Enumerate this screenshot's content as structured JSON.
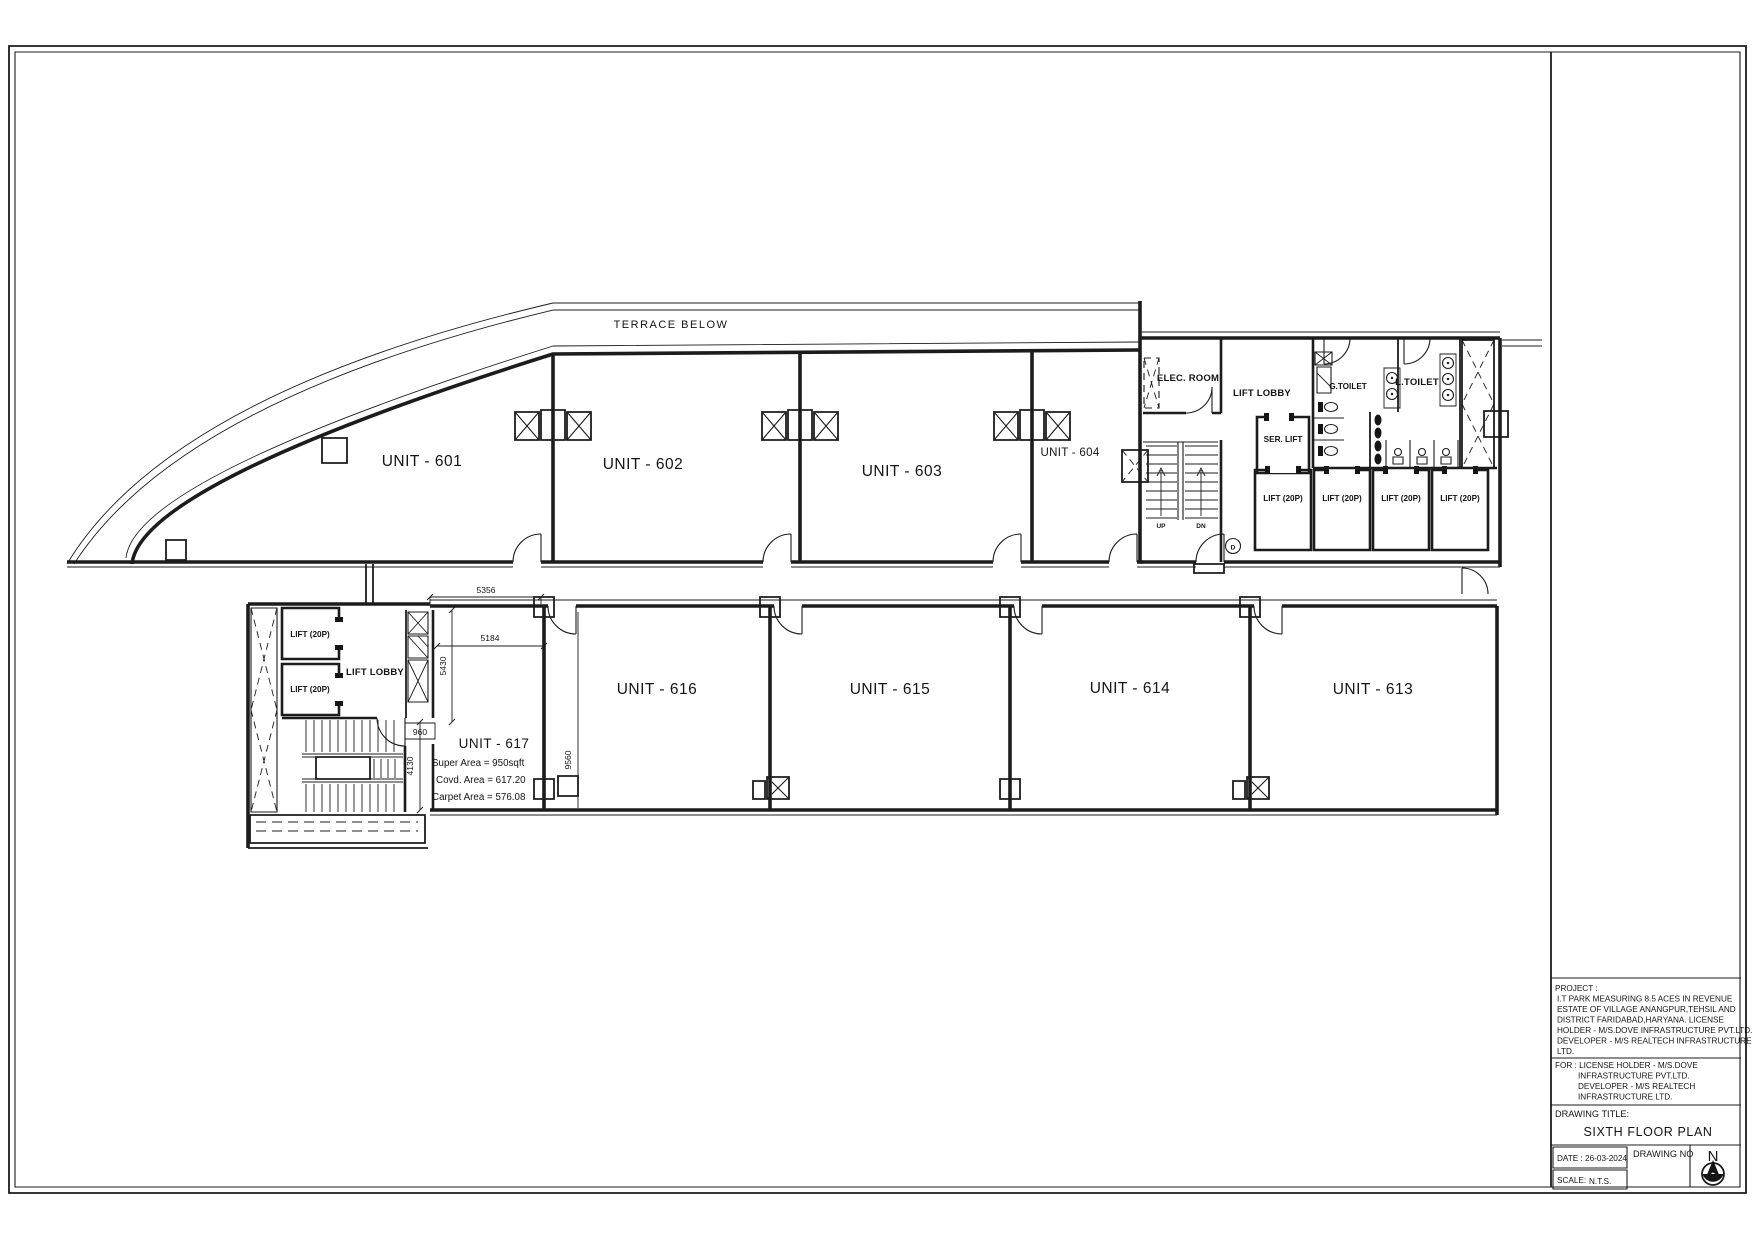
{
  "title_block": {
    "project_lines": [
      "PROJECT :",
      "I.T PARK MEASURING 8.5 ACES IN REVENUE",
      "ESTATE OF VILLAGE ANANGPUR,TEHSIL AND",
      "DISTRICT FARIDABAD,HARYANA. LICENSE",
      "HOLDER - M/S.DOVE INFRASTRUCTURE PVT.LTD.",
      "DEVELOPER - M/S REALTECH INFRASTRUCTURE",
      "LTD."
    ],
    "for_lines": [
      "FOR :  LICENSE HOLDER - M/S.DOVE",
      "INFRASTRUCTURE PVT.LTD.",
      "DEVELOPER - M/S REALTECH",
      "INFRASTRUCTURE LTD."
    ],
    "drawing_title_label": "DRAWING TITLE:",
    "drawing_title": "SIXTH FLOOR PLAN",
    "date": "DATE : 26-03-2024",
    "drawing_no_label": "DRAWING NO",
    "scale_label": "SCALE:",
    "scale_value": "N.T.S.",
    "north_label": "N"
  },
  "plan": {
    "terrace_label": "TERRACE BELOW",
    "units": {
      "u601": "UNIT - 601",
      "u602": "UNIT - 602",
      "u603": "UNIT - 603",
      "u604": "UNIT - 604",
      "u613": "UNIT - 613",
      "u614": "UNIT - 614",
      "u615": "UNIT - 615",
      "u616": "UNIT - 616",
      "u617": "UNIT - 617"
    },
    "unit617_areas": {
      "super": "Super Area =  950sqft",
      "covd": "Covd. Area =  617.20",
      "carpet": "Carpet Area =  576.08"
    },
    "rooms": {
      "elec": "ELEC. ROOM",
      "lift_lobby_upper": "LIFT LOBBY",
      "lift_lobby_lower": "LIFT LOBBY",
      "ser_lift": "SER. LIFT",
      "g_toilet": "G.TOILET",
      "l_toilet": "L.TOILET"
    },
    "lift_label": "LIFT (20P)",
    "stair": {
      "up": "UP",
      "dn": "DN",
      "door_tag": "D"
    },
    "dimensions": {
      "d5356": "5356",
      "d5184": "5184",
      "d5430": "5430",
      "d9560": "9560",
      "d960": "960",
      "d4130": "4130"
    },
    "colors": {
      "line": "#1c1c1c",
      "background": "#ffffff"
    }
  }
}
